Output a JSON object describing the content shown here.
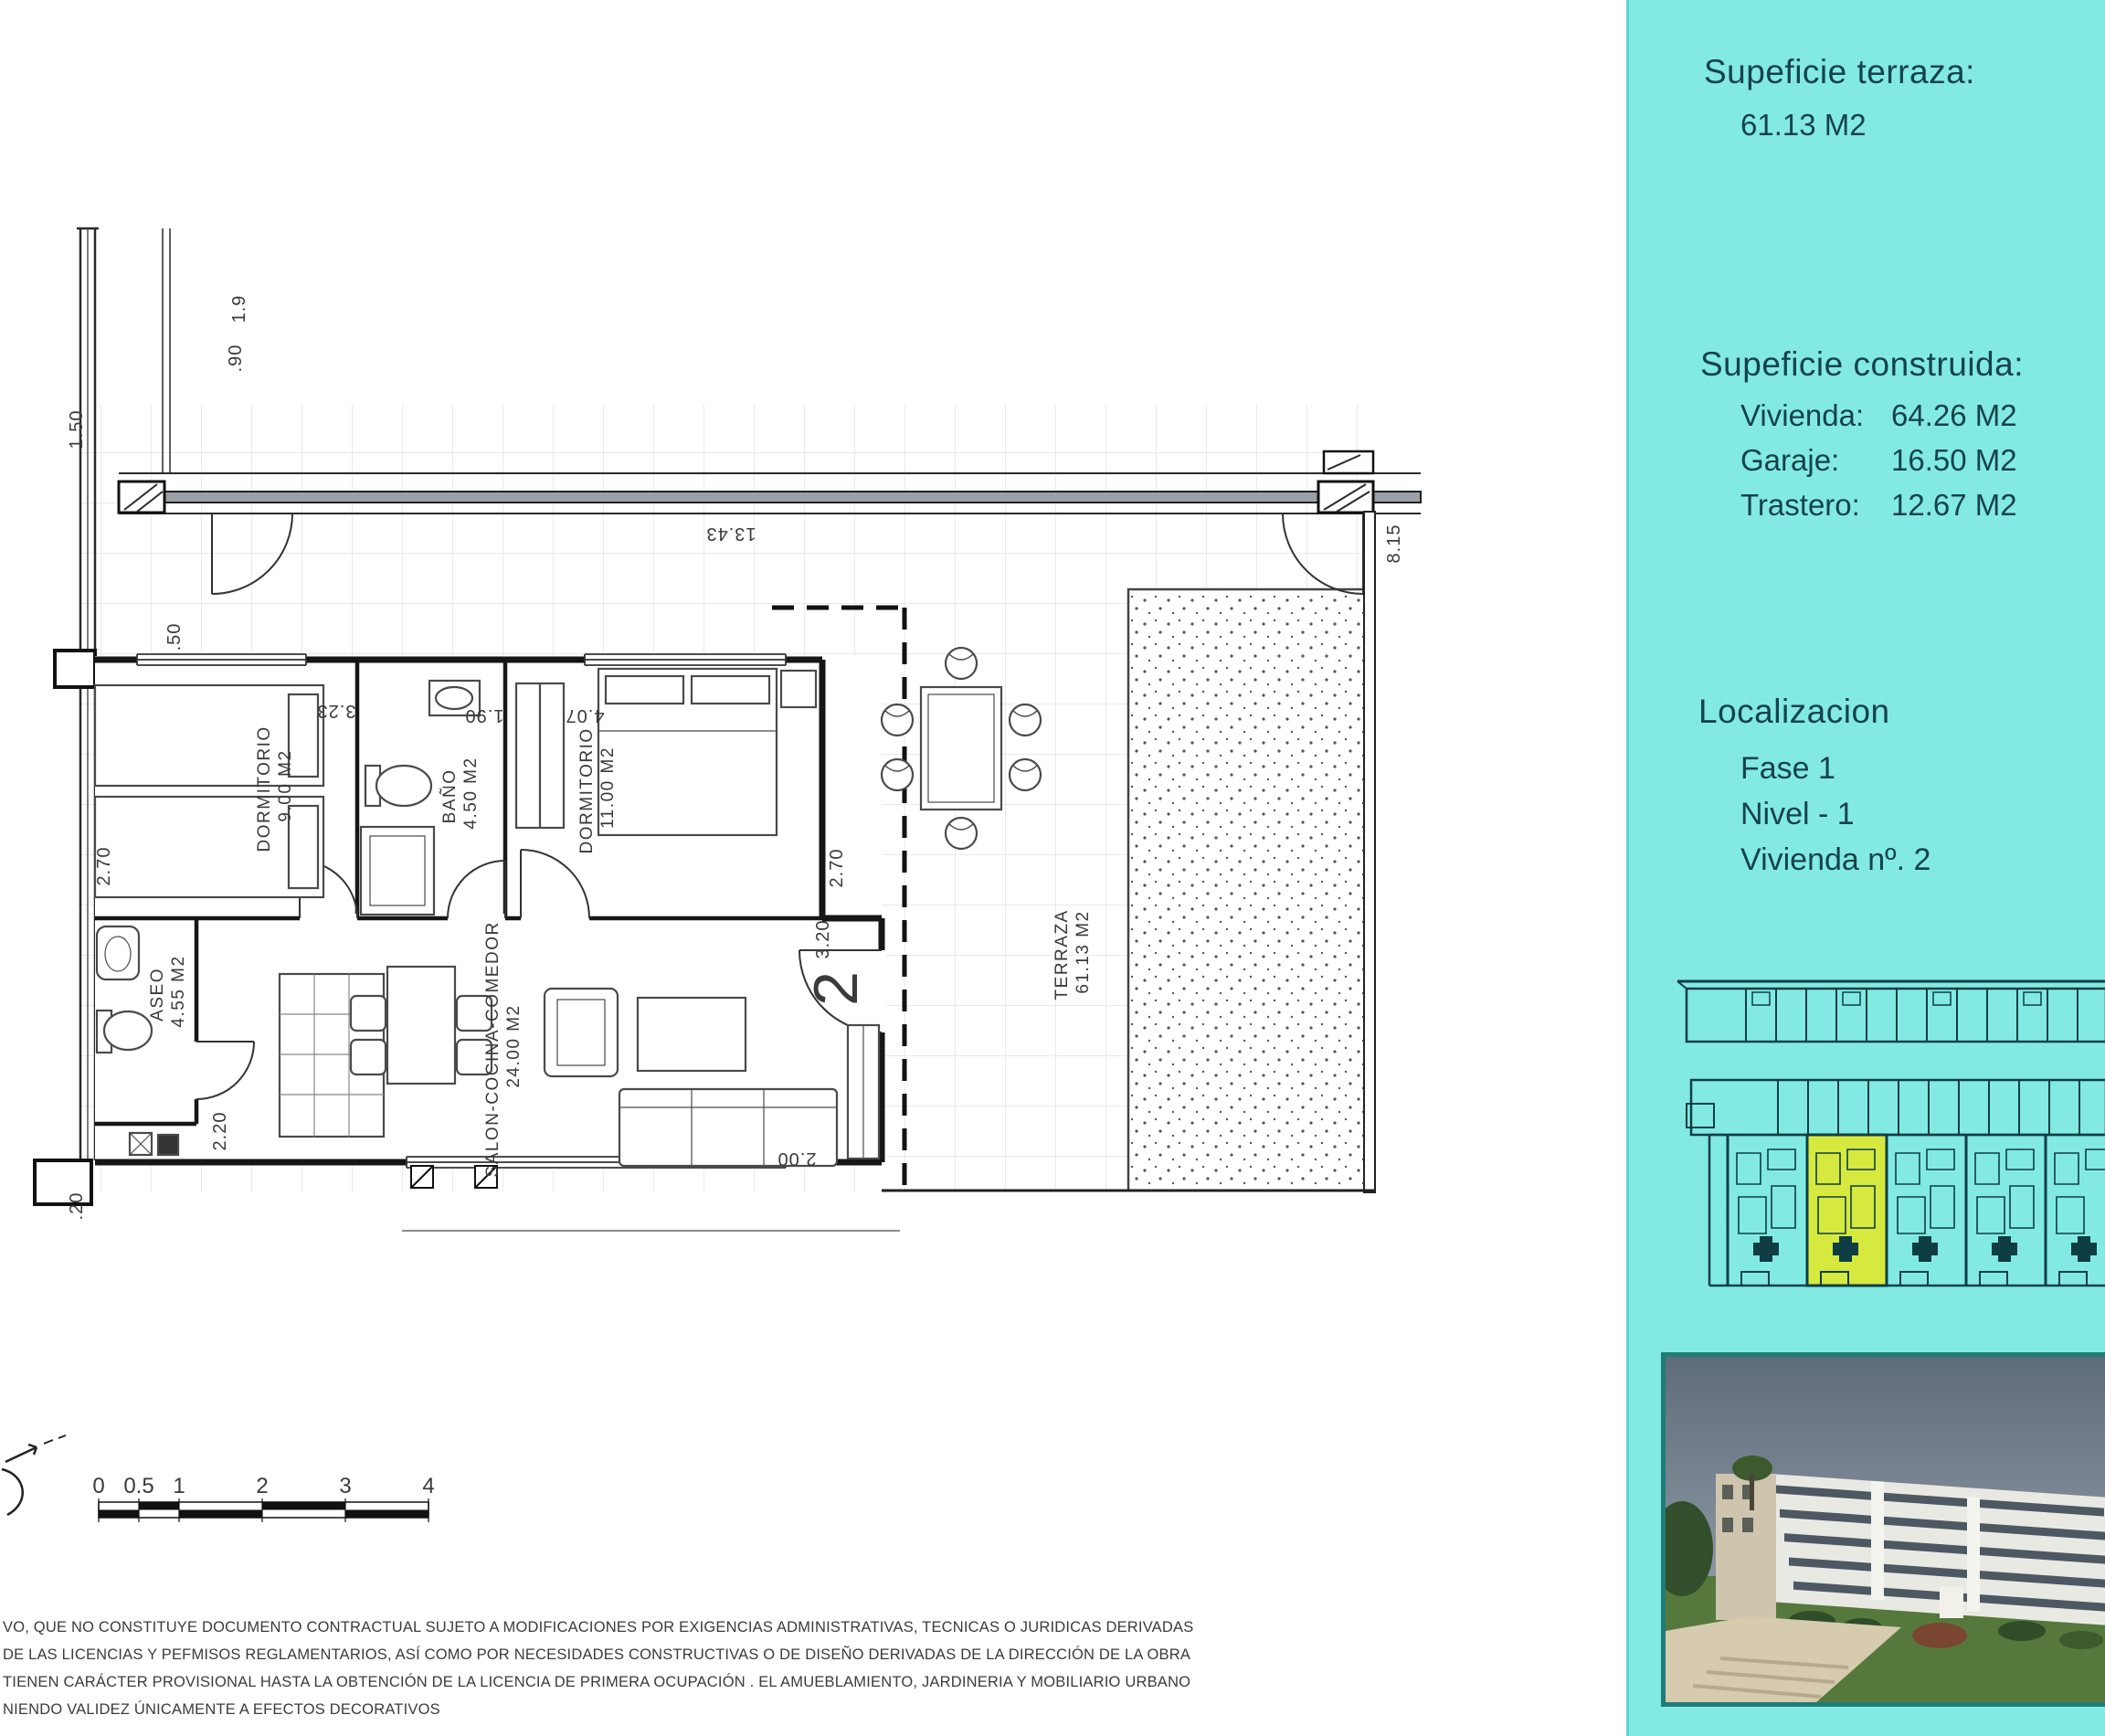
{
  "colors": {
    "sidebar_bg": "#82EAE3",
    "ink": "#15434A",
    "highlight": "#D6E93E",
    "photo_border": "#1f7d76"
  },
  "sidebar": {
    "terrace_title": "Supeficie terraza:",
    "terrace_value": "61.13 M2",
    "built_title": "Supeficie construida:",
    "built_rows": [
      {
        "label": "Vivienda:",
        "value": "64.26 M2"
      },
      {
        "label": "Garaje:",
        "value": "16.50 M2"
      },
      {
        "label": "Trastero:",
        "value": "12.67 M2"
      }
    ],
    "location_title": "Localizacion",
    "location_rows": [
      "Fase 1",
      "Nivel - 1",
      "Vivienda nº. 2"
    ]
  },
  "plan": {
    "unit_number": "2",
    "rooms": {
      "bed1": {
        "name": "DORMITORIO",
        "area": "9.00 M2"
      },
      "bath": {
        "name": "BAÑO",
        "area": "4.50 M2"
      },
      "bed2": {
        "name": "DORMITORIO",
        "area": "11.00 M2"
      },
      "aseo": {
        "name": "ASEO",
        "area": "4.55 M2"
      },
      "salon": {
        "name": "SALON-COCINA-COMEDOR",
        "area": "24.00 M2"
      },
      "terrace": {
        "name": "TERRAZA",
        "area": "61.13 M2"
      }
    },
    "dims": {
      "top_width": "13.43",
      "right_depth": "8.15",
      "left_height": "2.70",
      "bed2_height": "2.70",
      "entry_depth": "3.20",
      "aseo_height": "2.20",
      "bed1_width": "3.23",
      "bath_width": "1.90",
      "bed2_width": "4.07",
      "top_door_a": "1.9",
      "top_door_b": ".90",
      "left_top": "1.50",
      "hall": ".50",
      "bottom_door": "2.00",
      "bottom_left": ".20"
    }
  },
  "scalebar": {
    "labels": [
      "0",
      "0.5",
      "1",
      "2",
      "3",
      "4"
    ]
  },
  "disclaimer": {
    "lines": [
      "VO, QUE NO CONSTITUYE DOCUMENTO CONTRACTUAL SUJETO A MODIFICACIONES  POR EXIGENCIAS ADMINISTRATIVAS, TECNICAS O JURIDICAS DERIVADAS",
      "DE LAS LICENCIAS Y PEFMISOS REGLAMENTARIOS,  ASÍ COMO POR NECESIDADES CONSTRUCTIVAS  O DE DISEÑO DERIVADAS DE LA DIRECCIÓN DE LA OBRA",
      "TIENEN CARÁCTER PROVISIONAL HASTA LA OBTENCIÓN DE LA LICENCIA DE PRIMERA OCUPACIÓN . EL AMUEBLAMIENTO, JARDINERIA Y MOBILIARIO URBANO",
      "NIENDO VALIDEZ ÚNICAMENTE  A EFECTOS DECORATIVOS"
    ]
  }
}
